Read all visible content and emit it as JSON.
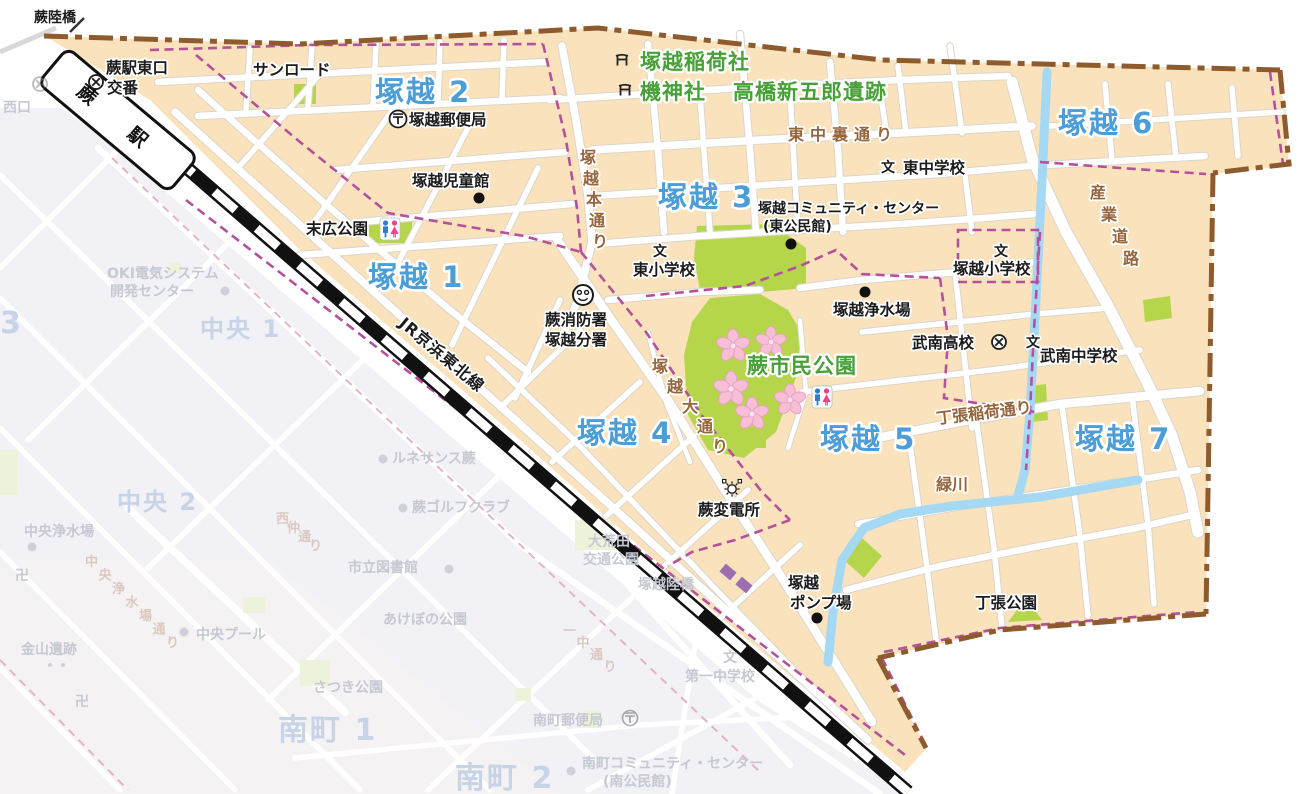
{
  "map_title": "塚越地区 地図 (蕨市)",
  "region_labels": {
    "t1": "塚越 1",
    "t2": "塚越 2",
    "t3": "塚越 3",
    "t4": "塚越 4",
    "t5": "塚越 5",
    "t6": "塚越 6",
    "t7": "塚越 7"
  },
  "green_labels": {
    "inari_sha": "塚越稲荷社",
    "hata_jinja": "機神社",
    "takahashi_iseki": "高橋新五郎遺跡",
    "shimin_koen": "蕨市民公園"
  },
  "facilities": {
    "warabi_rikkyo": "蕨陸橋",
    "koban_line1": "蕨駅東口",
    "koban_line2": "交番",
    "sunroad": "サンロード",
    "post_office": "塚越郵便局",
    "jidokan": "塚越児童館",
    "suehiro_park": "末広公園",
    "higashi_sho": "東小学校",
    "higashi_chu": "東中学校",
    "community_center1": "塚越コミュニティ・センター",
    "community_center2": "(東公民館)",
    "tsukagoshi_sho": "塚越小学校",
    "josuijo": "塚越浄水場",
    "fire1": "蕨消防署",
    "fire2": "塚越分署",
    "bunan_koko": "武南高校",
    "bunan_chu": "武南中学校",
    "hendensho": "蕨変電所",
    "pump1": "塚越",
    "pump2": "ポンプ場",
    "chohari_park": "丁張公園"
  },
  "road_labels": {
    "higashinaka_ura": "東中裏通り",
    "hon_dori": "塚越本通り",
    "sangyo_doro": "産業道路",
    "o_dori": "塚越大通り",
    "chohari_inari": "丁張稲荷通り",
    "midorikawa": "緑川",
    "jr_line": "JR京浜東北線"
  },
  "station": {
    "label": "蕨　駅"
  },
  "faded_labels": {
    "nishiguchi": "西口",
    "oki1": "OKI電気システム",
    "oki2": "開発センター",
    "chuo1": "中央 1",
    "chuo2": "中央 2",
    "chuo3_part": "3",
    "chuo_josuijo": "中央浄水場",
    "chuo_josui_dori": "中央浄水場通り",
    "chuo_pool": "中央プール",
    "kanayama": "金山遺跡",
    "toshokan": "市立図書館",
    "akebono": "あけぼの公園",
    "satsuki": "さつき公園",
    "minami1": "南町 1",
    "minami2": "南町 2",
    "minami_post": "南町郵便局",
    "minami_cc1": "南町コミュニティ・センター",
    "minami_cc2": "(南公民館)",
    "daiichi_chu": "第一中学校",
    "oarata1": "大荒田",
    "oarata2": "交通公園",
    "tsukagoshi_rikkyo": "塚越陸橋",
    "renaissance": "ルネサンス蕨",
    "golf": "蕨ゴルフクラブ",
    "icchu_dori": "一中通り",
    "nishinaka_dori": "西仲通り",
    "manji": "卍"
  },
  "glyphs": {
    "post": "〒",
    "school": "文",
    "temple": "卍"
  },
  "colors": {
    "district_fill": "#FAE3BC",
    "area_label_blue": "#4D9ED6",
    "landmark_green": "#48A038",
    "park_fill": "#B5D64B",
    "water_blue": "#A5D8F3",
    "city_boundary_brown": "#8D5B2D",
    "ward_boundary_purple": "#B5519C",
    "road_label_brown": "#96653B",
    "railway_black": "#111111",
    "sakura_pink": "#F6BFD6"
  }
}
